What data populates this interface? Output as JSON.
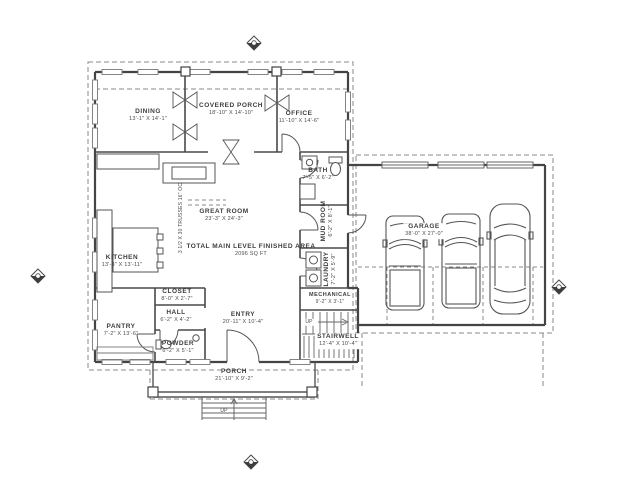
{
  "drawing": {
    "type": "architectural-floor-plan",
    "colors": {
      "wall": "#444444",
      "interior": "#555555",
      "dashed": "#8a8a8a",
      "background": "#ffffff"
    }
  },
  "rooms": {
    "dining": {
      "name": "DINING",
      "dims": "13'-1\" X 14'-1\""
    },
    "covered_porch": {
      "name": "COVERED PORCH",
      "dims": "18'-10\" X 14'-10\""
    },
    "office": {
      "name": "OFFICE",
      "dims": "11'-10\" X 14'-6\""
    },
    "great_room": {
      "name": "GREAT ROOM",
      "dims": "23'-3\" X 24'-3\""
    },
    "kitchen": {
      "name": "KITCHEN",
      "dims": "13'-3\" X 13'-11\""
    },
    "bath": {
      "name": "BATH",
      "dims": "7'-5\" X 6'-2\""
    },
    "mud_room": {
      "name": "MUD ROOM",
      "dims": "6'-2\" X 8'-1\""
    },
    "laundry": {
      "name": "LAUNDRY",
      "dims": "7'-2\" X 5'-9\""
    },
    "mechanical": {
      "name": "MECHANICAL",
      "dims": "9'-2\" X 3'-1\""
    },
    "closet": {
      "name": "CLOSET",
      "dims": "8'-0\" X 2'-7\""
    },
    "hall": {
      "name": "HALL",
      "dims": "6'-2\" X 4'-2\""
    },
    "pantry": {
      "name": "PANTRY",
      "dims": "7'-2\" X 13'-6\""
    },
    "powder": {
      "name": "POWDER",
      "dims": "6'-2\" X 5'-1\""
    },
    "entry": {
      "name": "ENTRY",
      "dims": "20'-11\" X 10'-4\""
    },
    "stairwell": {
      "name": "STAIRWELL",
      "dims": "12'-4\" X 10'-4\""
    },
    "garage": {
      "name": "GARAGE",
      "dims": "38'-0\" X 27'-0\""
    },
    "porch": {
      "name": "PORCH",
      "dims": "21'-10\" X 9'-2\""
    }
  },
  "annotations": {
    "total_area_label": "TOTAL MAIN LEVEL FINISHED AREA",
    "total_area_value": "2096 SQ FT",
    "truss_note": "3 1/2 X 30 TRUSSES 16\" OC",
    "stair_up": "UP",
    "steps_up": "UP"
  },
  "icons": {
    "section_markers": [
      "top",
      "left",
      "right",
      "bottom"
    ]
  }
}
